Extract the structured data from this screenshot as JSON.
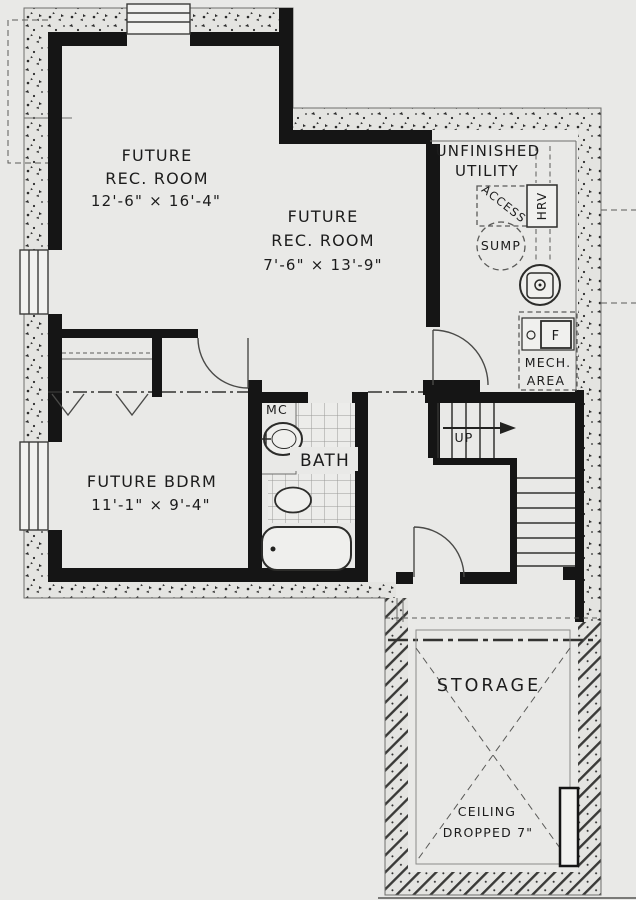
{
  "rooms": {
    "rec1": {
      "line1": "FUTURE",
      "line2": "REC. ROOM",
      "dims": "12'-6\" × 16'-4\""
    },
    "rec2": {
      "line1": "FUTURE",
      "line2": "REC. ROOM",
      "dims": "7'-6\" × 13'-9\""
    },
    "utility": {
      "line1": "UNFINISHED",
      "line2": "UTILITY"
    },
    "bedroom": {
      "line1": "FUTURE BDRM",
      "dims": "11'-1\" × 9'-4\""
    },
    "bath": {
      "label": "BATH",
      "medicine_cabinet": "MC"
    },
    "storage": {
      "label": "STORAGE",
      "note_line1": "CEILING",
      "note_line2": "DROPPED 7\""
    },
    "mech_area": {
      "line1": "MECH.",
      "line2": "AREA",
      "furnace": "F"
    },
    "stairs": {
      "direction": "UP"
    }
  },
  "equipment": {
    "access": "ACCESS",
    "hrv": "HRV",
    "sump": "SUMP"
  },
  "colors": {
    "background": "#e9e9e7",
    "walls": "#151515",
    "concrete_fill": "#e4e4e1",
    "text": "#1c1c1c"
  }
}
